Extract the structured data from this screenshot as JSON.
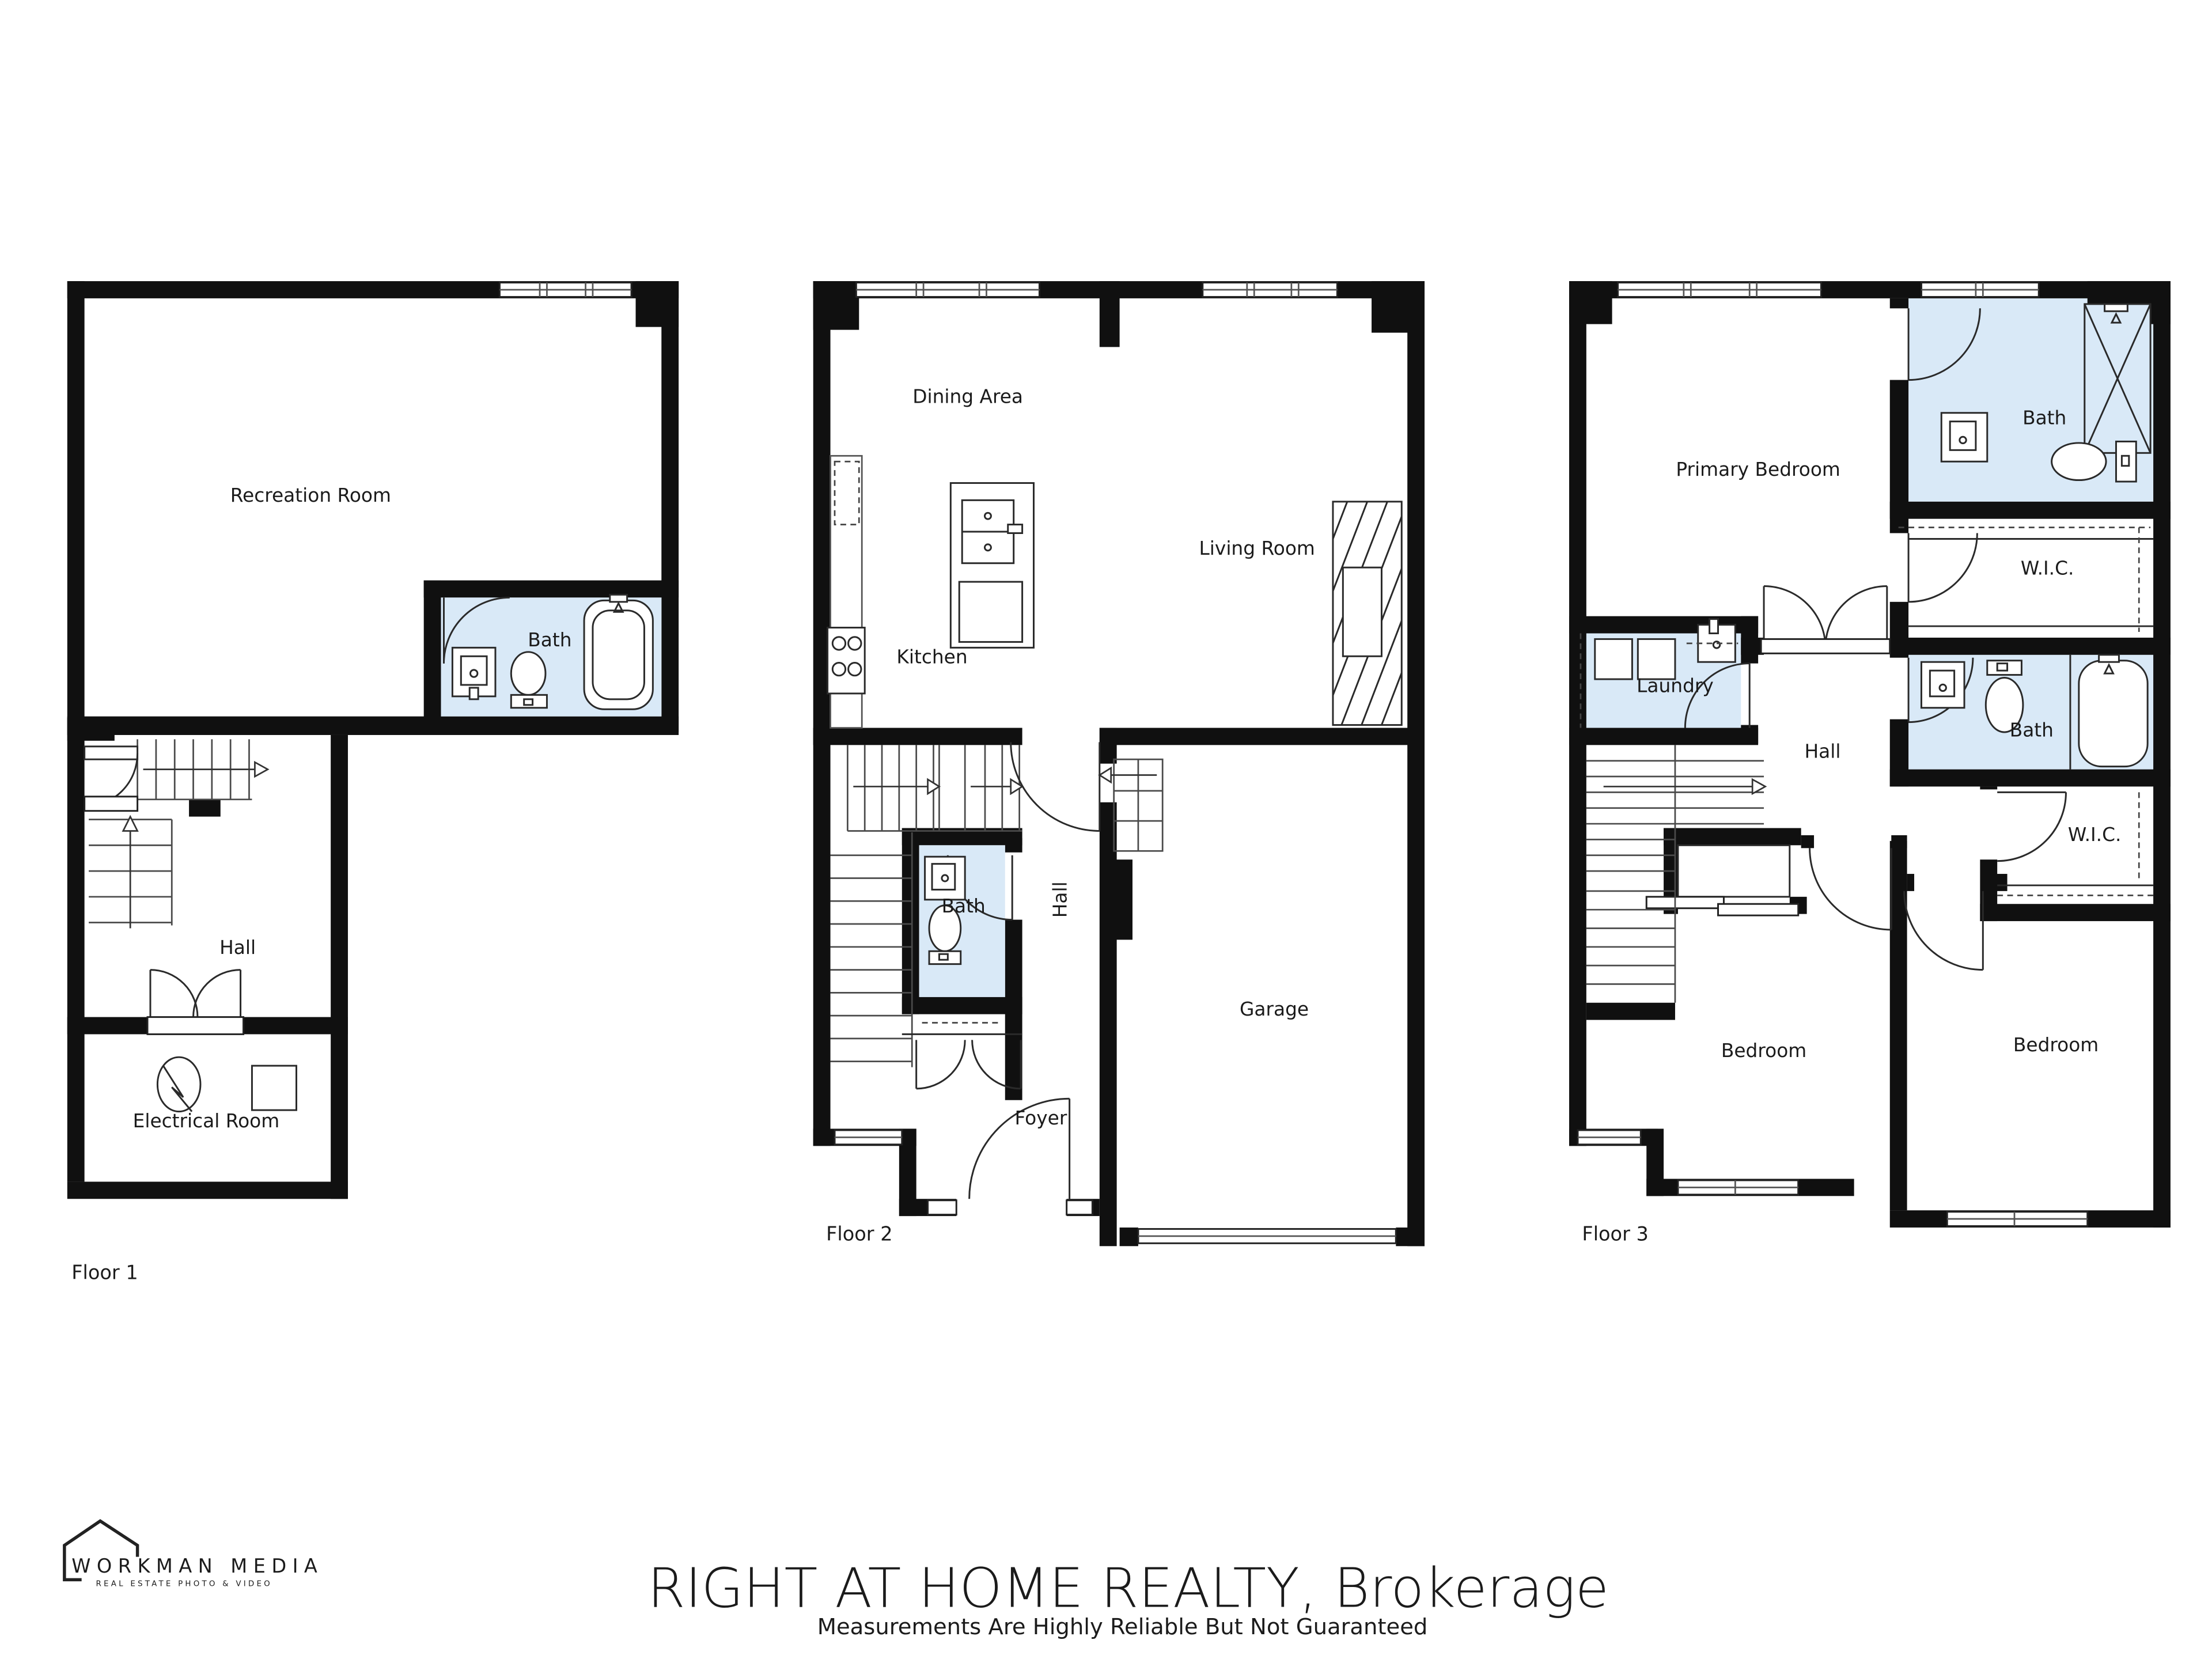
{
  "colors": {
    "wall": "#101010",
    "bath_fill": "#d9e9f7",
    "watermark": "#d8d8d8"
  },
  "floors": [
    {
      "id": "floor-1",
      "label": "Floor 1",
      "rooms": {
        "recreation": {
          "label": "Recreation Room"
        },
        "bath": {
          "label": "Bath"
        },
        "hall": {
          "label": "Hall"
        },
        "electrical": {
          "label": "Electrical Room"
        }
      }
    },
    {
      "id": "floor-2",
      "label": "Floor 2",
      "rooms": {
        "dining": {
          "label": "Dining Area"
        },
        "living": {
          "label": "Living Room"
        },
        "kitchen": {
          "label": "Kitchen"
        },
        "bath": {
          "label": "Bath"
        },
        "hall": {
          "label": "Hall"
        },
        "garage": {
          "label": "Garage"
        },
        "foyer": {
          "label": "Foyer"
        }
      }
    },
    {
      "id": "floor-3",
      "label": "Floor 3",
      "rooms": {
        "primary_bedroom": {
          "label": "Primary Bedroom"
        },
        "bath_primary": {
          "label": "Bath"
        },
        "wic_primary": {
          "label": "W.I.C."
        },
        "laundry": {
          "label": "Laundry"
        },
        "hall": {
          "label": "Hall"
        },
        "bath": {
          "label": "Bath"
        },
        "wic": {
          "label": "W.I.C."
        },
        "bedroom_left": {
          "label": "Bedroom"
        },
        "bedroom_right": {
          "label": "Bedroom"
        }
      }
    }
  ],
  "footer": {
    "logo_name": "WORKMAN MEDIA",
    "logo_tagline": "REAL ESTATE PHOTO & VIDEO",
    "watermark": "RIGHT AT HOME REALTY, Brokerage",
    "disclaimer": "Measurements Are Highly Reliable But Not Guaranteed"
  }
}
